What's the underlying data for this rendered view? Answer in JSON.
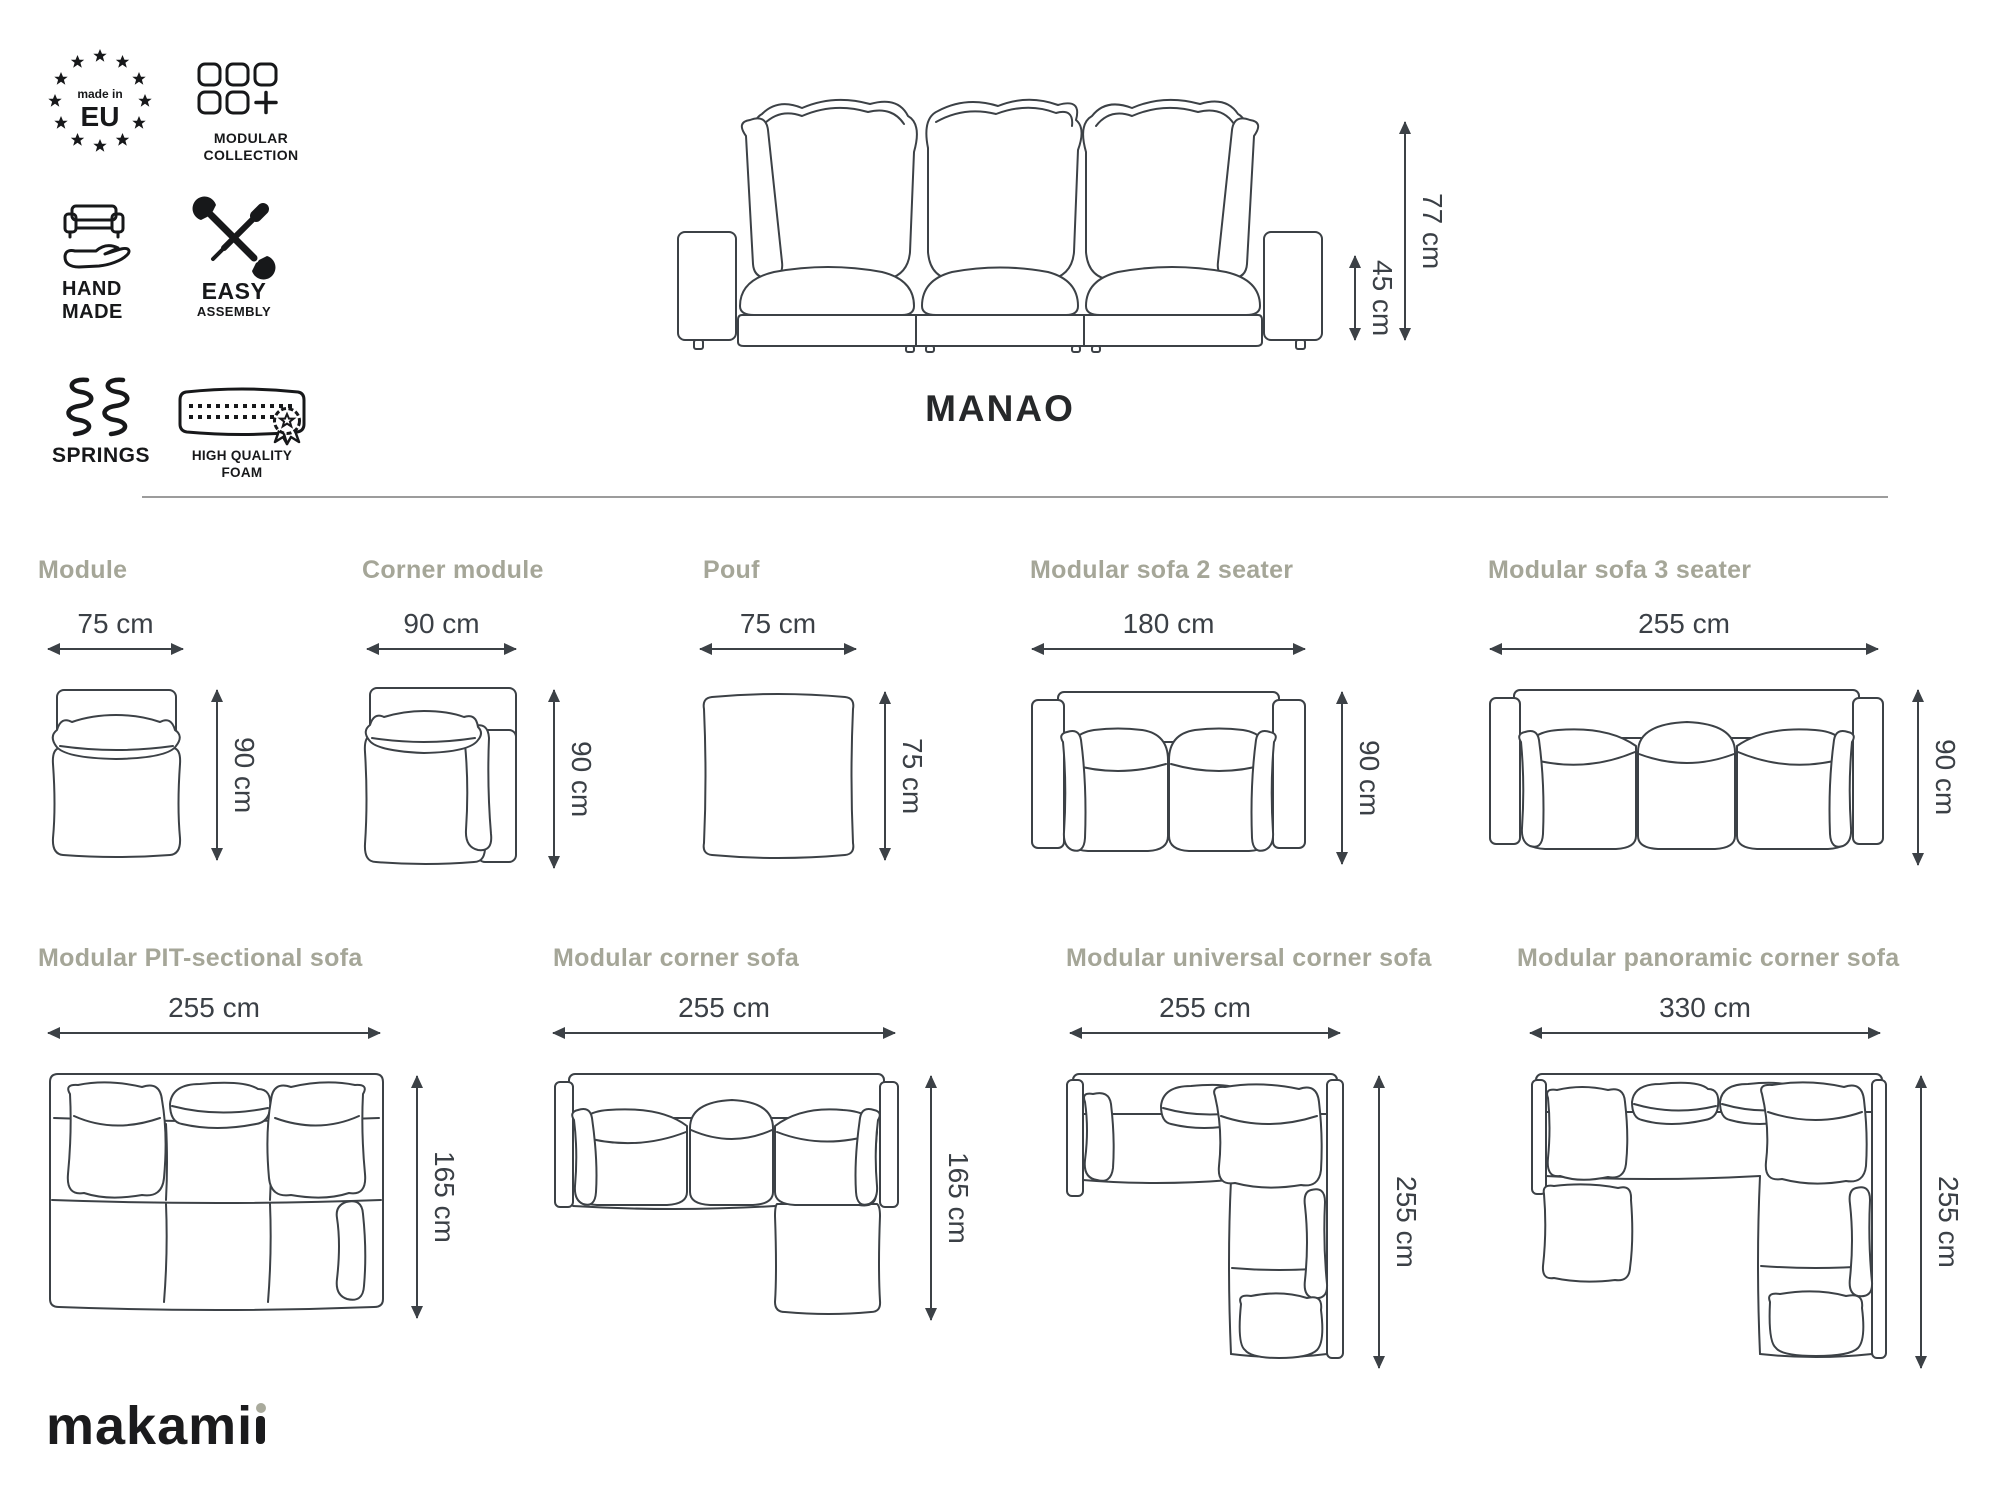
{
  "badges": {
    "made_in_eu": {
      "line1": "made in",
      "line2": "EU"
    },
    "modular_collection": {
      "line1": "MODULAR",
      "line2": "COLLECTION"
    },
    "hand_made": {
      "line1": "HAND",
      "line2": "MADE"
    },
    "easy_assembly": {
      "line1": "EASY",
      "line2": "ASSEMBLY"
    },
    "springs": {
      "label": "SPRINGS"
    },
    "high_quality_foam": {
      "line1": "HIGH QUALITY",
      "line2": "FOAM"
    }
  },
  "product": {
    "name": "MANAO"
  },
  "front_view": {
    "total_height": "77 cm",
    "seat_height": "45 cm"
  },
  "modules": [
    {
      "name": "Module",
      "width": "75 cm",
      "depth": "90 cm"
    },
    {
      "name": "Corner module",
      "width": "90 cm",
      "depth": "90 cm"
    },
    {
      "name": "Pouf",
      "width": "75 cm",
      "depth": "75 cm"
    },
    {
      "name": "Modular sofa 2 seater",
      "width": "180 cm",
      "depth": "90 cm"
    },
    {
      "name": "Modular sofa 3 seater",
      "width": "255 cm",
      "depth": "90 cm"
    },
    {
      "name": "Modular PIT-sectional sofa",
      "width": "255 cm",
      "depth": "165 cm"
    },
    {
      "name": "Modular corner sofa",
      "width": "255 cm",
      "depth": "165 cm"
    },
    {
      "name": "Modular universal corner sofa",
      "width": "255 cm",
      "depth": "255 cm"
    },
    {
      "name": "Modular panoramic corner sofa",
      "width": "330 cm",
      "depth": "255 cm"
    }
  ],
  "logo": {
    "text_main": "makami",
    "accent_letter": "i"
  },
  "colors": {
    "label": "#a5a698",
    "line": "#3c4146",
    "dimension_text": "#3b4046",
    "icon": "#17181a",
    "divider": "#9c9c9c",
    "logo_accent": "#a9aa9c"
  }
}
